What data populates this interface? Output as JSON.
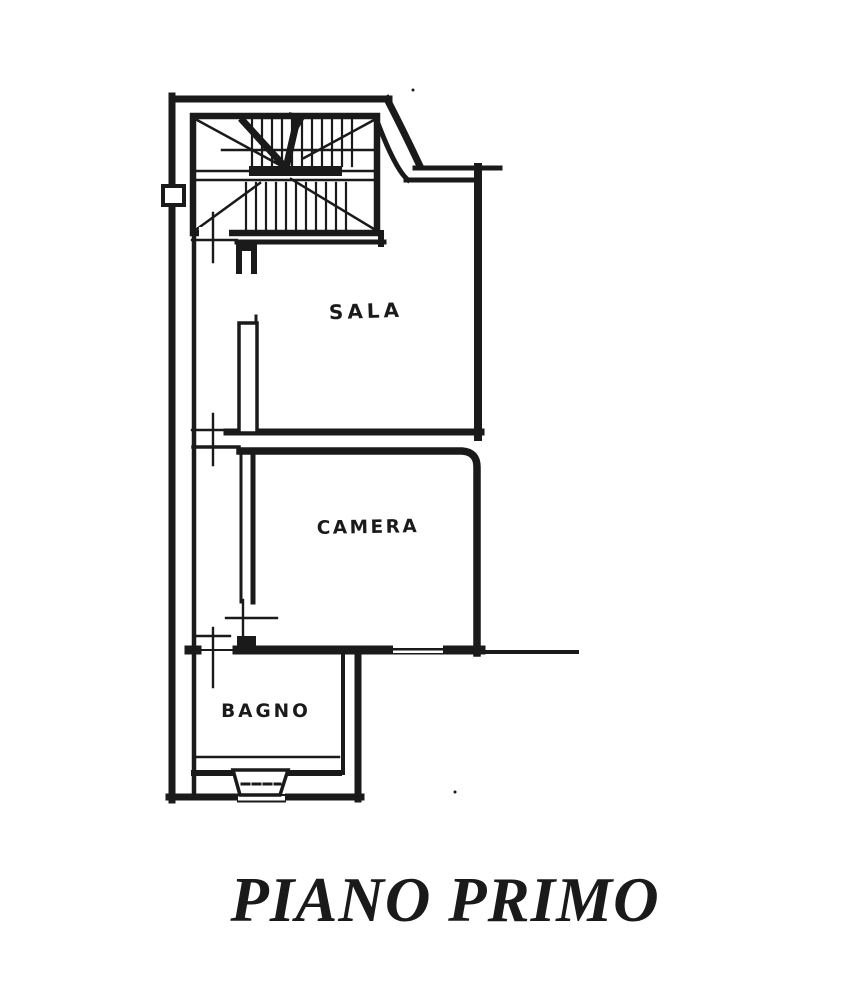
{
  "theme": {
    "ink": "#1a1a1a",
    "paper": "#ffffff"
  },
  "plan": {
    "rooms": {
      "sala": {
        "label": "SALA"
      },
      "camera": {
        "label": "CAMERA"
      },
      "bagno": {
        "label": "BAGNO"
      }
    },
    "symbols": {
      "stairs": "staircase-with-direction-arrow",
      "door_mark": "door-axis-cross-mark",
      "window_bay": "bay-window-marker",
      "balcony": "balcony-parapet-lines"
    }
  },
  "title": {
    "text": "PIANO PRIMO"
  }
}
